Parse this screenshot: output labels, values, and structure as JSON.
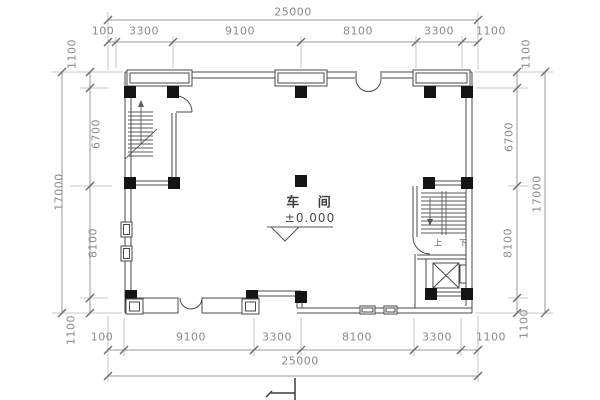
{
  "drawing": {
    "room_label": "车 间",
    "elevation_label": "±0.000",
    "stair_up": "上",
    "stair_down": "下"
  },
  "dimensions": {
    "top": {
      "total": "25000",
      "segments": [
        "100",
        "3300",
        "9100",
        "8100",
        "3300",
        "1100"
      ]
    },
    "bottom": {
      "total": "25000",
      "segments": [
        "100",
        "9100",
        "3300",
        "8100",
        "3300",
        "1100"
      ]
    },
    "left": {
      "total": "17000",
      "segments": [
        "1100",
        "6700",
        "8100",
        "1100"
      ]
    },
    "right": {
      "total": "17000",
      "segments": [
        "1100",
        "6700",
        "8100",
        "1100"
      ]
    }
  },
  "colors": {
    "wall": "#4a4a4a",
    "column": "#141414",
    "dimension_line": "#9a9a9a",
    "dimension_text": "#8a8a8a",
    "plan_text": "#3f3f3f",
    "background": "#ffffff"
  }
}
